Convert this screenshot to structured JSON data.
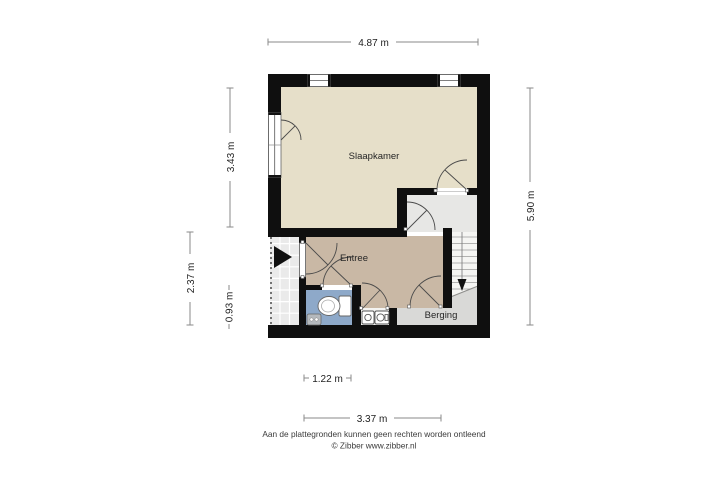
{
  "floorplan": {
    "rooms": {
      "slaapkamer": "Slaapkamer",
      "entree": "Entree",
      "berging": "Berging"
    },
    "dimensions": {
      "top": "4.87 m",
      "left_upper": "3.43 m",
      "left_outer": "2.37 m",
      "left_inner": "0.93 m",
      "right": "5.90 m",
      "bottom_inner": "1.22 m",
      "bottom_outer": "3.37 m"
    },
    "icons": {
      "entry_arrow": "entry-direction-arrow",
      "stairs_down_arrow": "stairs-down-arrow",
      "toilet": "toilet-top-view",
      "sink": "washbasin",
      "appliance_left": "appliance-front-load",
      "appliance_right": "appliance-front-load"
    },
    "colors": {
      "wall": "#0f0f0f",
      "slaapkamer_floor": "#e6dfc9",
      "entree_floor": "#c9b8a5",
      "bathroom_floor": "#8ea9c9",
      "landing_floor": "#e7e7e5",
      "stairs_floor": "#f5f5f3",
      "berging_floor": "#d9d9d7",
      "porch_floor": "#eaeaea",
      "dimension_line": "#8a8a8a",
      "label_text": "#222222"
    }
  },
  "footer": {
    "disclaimer": "Aan de plattegronden kunnen geen rechten worden ontleend",
    "credit": "© Zibber www.zibber.nl"
  }
}
